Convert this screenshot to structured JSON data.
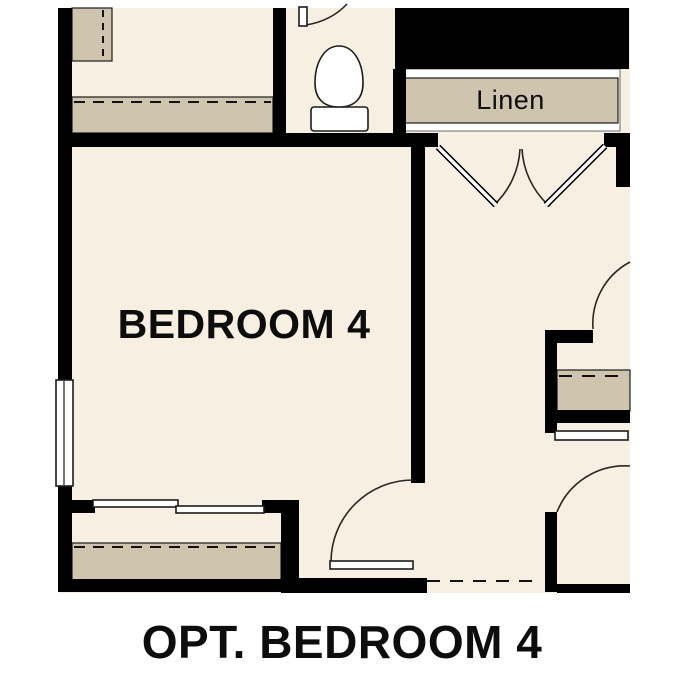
{
  "plan": {
    "caption": "OPT. BEDROOM 4",
    "bedroom_label": "BEDROOM 4",
    "linen_label": "Linen"
  },
  "colors": {
    "floor": "#f7efe2",
    "shelf": "#cfc4ae",
    "wall": "#000000",
    "page": "#ffffff",
    "line": "#1c1c1c"
  }
}
